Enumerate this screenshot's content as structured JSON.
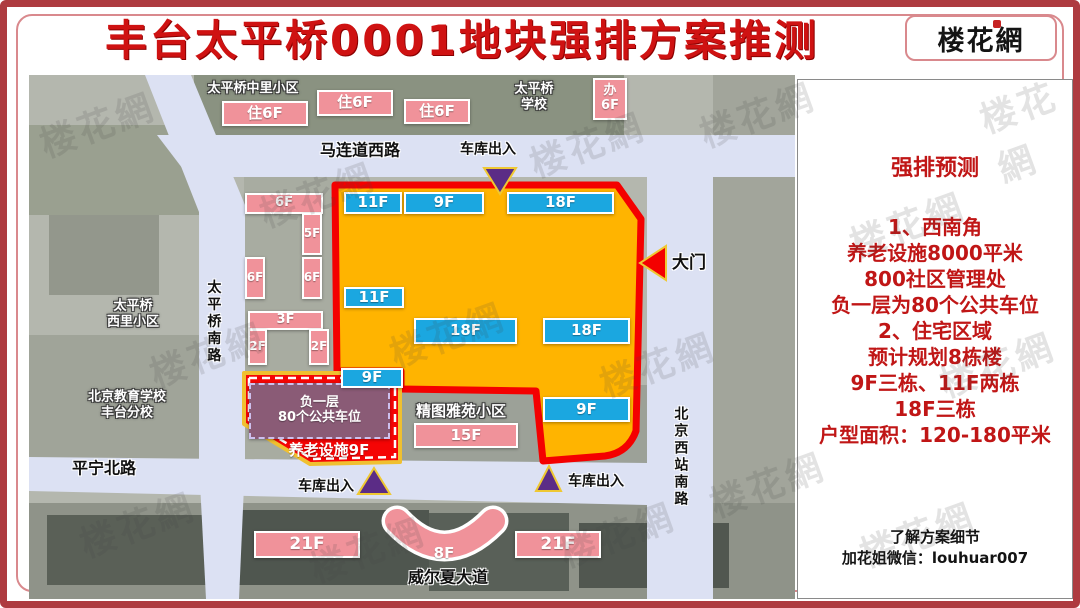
{
  "page": {
    "title": "丰台太平桥0001地块强排方案推测",
    "logo": "楼花網",
    "watermark_text": "楼花網"
  },
  "colors": {
    "plot_fill": "#FFB400",
    "plot_border": "#F40000",
    "building_blue": "#1BA7E0",
    "building_pink": "#F0929A",
    "parking_purple": "#8A5B76",
    "road": "#DCE1F3",
    "marker_purple": "#5B2C86",
    "marker_red": "#F40000",
    "marker_outline": "#EFC832",
    "panel_text_red": "#C01616",
    "sw_area_red": "#F50505"
  },
  "map": {
    "labels": [
      {
        "text": "太平桥中里小区",
        "x": 224,
        "y": 14,
        "fs": 13,
        "style": "outline"
      },
      {
        "text": "太平桥\n学校",
        "x": 505,
        "y": 22,
        "fs": 13,
        "style": "outline"
      },
      {
        "text": "马连道西路",
        "x": 331,
        "y": 75,
        "fs": 16,
        "style": "black"
      },
      {
        "text": "车库出入",
        "x": 459,
        "y": 75,
        "fs": 14,
        "style": "black"
      },
      {
        "text": "大门",
        "x": 660,
        "y": 188,
        "fs": 17,
        "style": "black"
      },
      {
        "text": "太平桥南路",
        "x": 184,
        "y": 247,
        "fs": 14,
        "style": "black",
        "vertical": true
      },
      {
        "text": "太平桥\n西里小区",
        "x": 104,
        "y": 239,
        "fs": 13,
        "style": "outline"
      },
      {
        "text": "北京教育学校\n丰台分校",
        "x": 98,
        "y": 330,
        "fs": 13,
        "style": "outline"
      },
      {
        "text": "平宁北路",
        "x": 75,
        "y": 393,
        "fs": 16,
        "style": "black"
      },
      {
        "text": "车库出入",
        "x": 297,
        "y": 412,
        "fs": 14,
        "style": "black"
      },
      {
        "text": "车库出入",
        "x": 567,
        "y": 407,
        "fs": 14,
        "style": "black"
      },
      {
        "text": "精图雅苑小区",
        "x": 432,
        "y": 336,
        "fs": 15,
        "style": "outline"
      },
      {
        "text": "威尔夏大道",
        "x": 419,
        "y": 502,
        "fs": 16,
        "style": "black"
      },
      {
        "text": "北京西站南路",
        "x": 651,
        "y": 382,
        "fs": 14,
        "style": "black",
        "vertical": true
      },
      {
        "text": "养老设施9F",
        "x": 300,
        "y": 375,
        "fs": 15,
        "style": "white"
      },
      {
        "text": "8F",
        "x": 415,
        "y": 478,
        "fs": 15,
        "style": "white"
      }
    ],
    "buildings": [
      {
        "type": "pink",
        "label": "住6F",
        "x": 193,
        "y": 26,
        "w": 86,
        "h": 25
      },
      {
        "type": "pink",
        "label": "住6F",
        "x": 288,
        "y": 15,
        "w": 76,
        "h": 26
      },
      {
        "type": "pink",
        "label": "住6F",
        "x": 375,
        "y": 24,
        "w": 66,
        "h": 25
      },
      {
        "type": "pink",
        "label": "办\n6F",
        "x": 564,
        "y": 3,
        "w": 34,
        "h": 42,
        "fs": 13
      },
      {
        "type": "pink",
        "label": "6F",
        "x": 216,
        "y": 118,
        "w": 78,
        "h": 21,
        "fs": 13
      },
      {
        "type": "pink",
        "label": "5F",
        "x": 273,
        "y": 138,
        "w": 20,
        "h": 42,
        "fs": 12
      },
      {
        "type": "pink",
        "label": "6F",
        "x": 216,
        "y": 182,
        "w": 20,
        "h": 42,
        "fs": 12
      },
      {
        "type": "pink",
        "label": "6F",
        "x": 273,
        "y": 182,
        "w": 20,
        "h": 42,
        "fs": 12
      },
      {
        "type": "pink",
        "label": "3F",
        "x": 219,
        "y": 236,
        "w": 75,
        "h": 19,
        "fs": 13
      },
      {
        "type": "pink",
        "label": "2F",
        "x": 219,
        "y": 254,
        "w": 19,
        "h": 36,
        "fs": 12
      },
      {
        "type": "pink",
        "label": "2F",
        "x": 280,
        "y": 254,
        "w": 20,
        "h": 36,
        "fs": 12
      },
      {
        "type": "purple",
        "label": "负一层\n80个公共车位",
        "x": 220,
        "y": 308,
        "w": 141,
        "h": 56,
        "fs": 13
      },
      {
        "type": "pink",
        "label": "15F",
        "x": 385,
        "y": 348,
        "w": 104,
        "h": 25
      },
      {
        "type": "pink",
        "label": "21F",
        "x": 225,
        "y": 456,
        "w": 106,
        "h": 27,
        "fs": 17
      },
      {
        "type": "pink",
        "label": "21F",
        "x": 486,
        "y": 456,
        "w": 86,
        "h": 27,
        "fs": 17
      },
      {
        "type": "blue",
        "label": "11F",
        "x": 315,
        "y": 117,
        "w": 58,
        "h": 22
      },
      {
        "type": "blue",
        "label": "9F",
        "x": 375,
        "y": 117,
        "w": 80,
        "h": 22
      },
      {
        "type": "blue",
        "label": "18F",
        "x": 478,
        "y": 117,
        "w": 107,
        "h": 22
      },
      {
        "type": "blue",
        "label": "11F",
        "x": 315,
        "y": 212,
        "w": 60,
        "h": 21
      },
      {
        "type": "blue",
        "label": "18F",
        "x": 385,
        "y": 243,
        "w": 103,
        "h": 26
      },
      {
        "type": "blue",
        "label": "18F",
        "x": 514,
        "y": 243,
        "w": 87,
        "h": 26
      },
      {
        "type": "blue",
        "label": "9F",
        "x": 312,
        "y": 293,
        "w": 62,
        "h": 20
      },
      {
        "type": "blue",
        "label": "9F",
        "x": 514,
        "y": 322,
        "w": 87,
        "h": 25
      }
    ],
    "markers": [
      {
        "name": "garage-entry-arrow-top",
        "color": "purple",
        "points": "455,93 487,93 471,119"
      },
      {
        "name": "main-gate-arrow",
        "color": "red",
        "points": "637,171 637,205 611,188"
      },
      {
        "name": "garage-entry-arrow-bottom-left",
        "color": "purple",
        "points": "329,419 361,419 345,393"
      },
      {
        "name": "garage-entry-arrow-bottom-center",
        "color": "purple",
        "points": "507,416 532,416 520,391"
      }
    ]
  },
  "panel": {
    "title": "强排预测",
    "lines": [
      "1、西南角",
      "养老设施8000平米",
      "800社区管理处",
      "负一层为80个公共车位",
      "2、住宅区域",
      "预计规划8栋楼",
      "9F三栋、11F两栋",
      "18F三栋",
      "户型面积：120-180平米"
    ],
    "footer_line1": "了解方案细节",
    "footer_line2": "加花姐微信：louhuar007"
  }
}
